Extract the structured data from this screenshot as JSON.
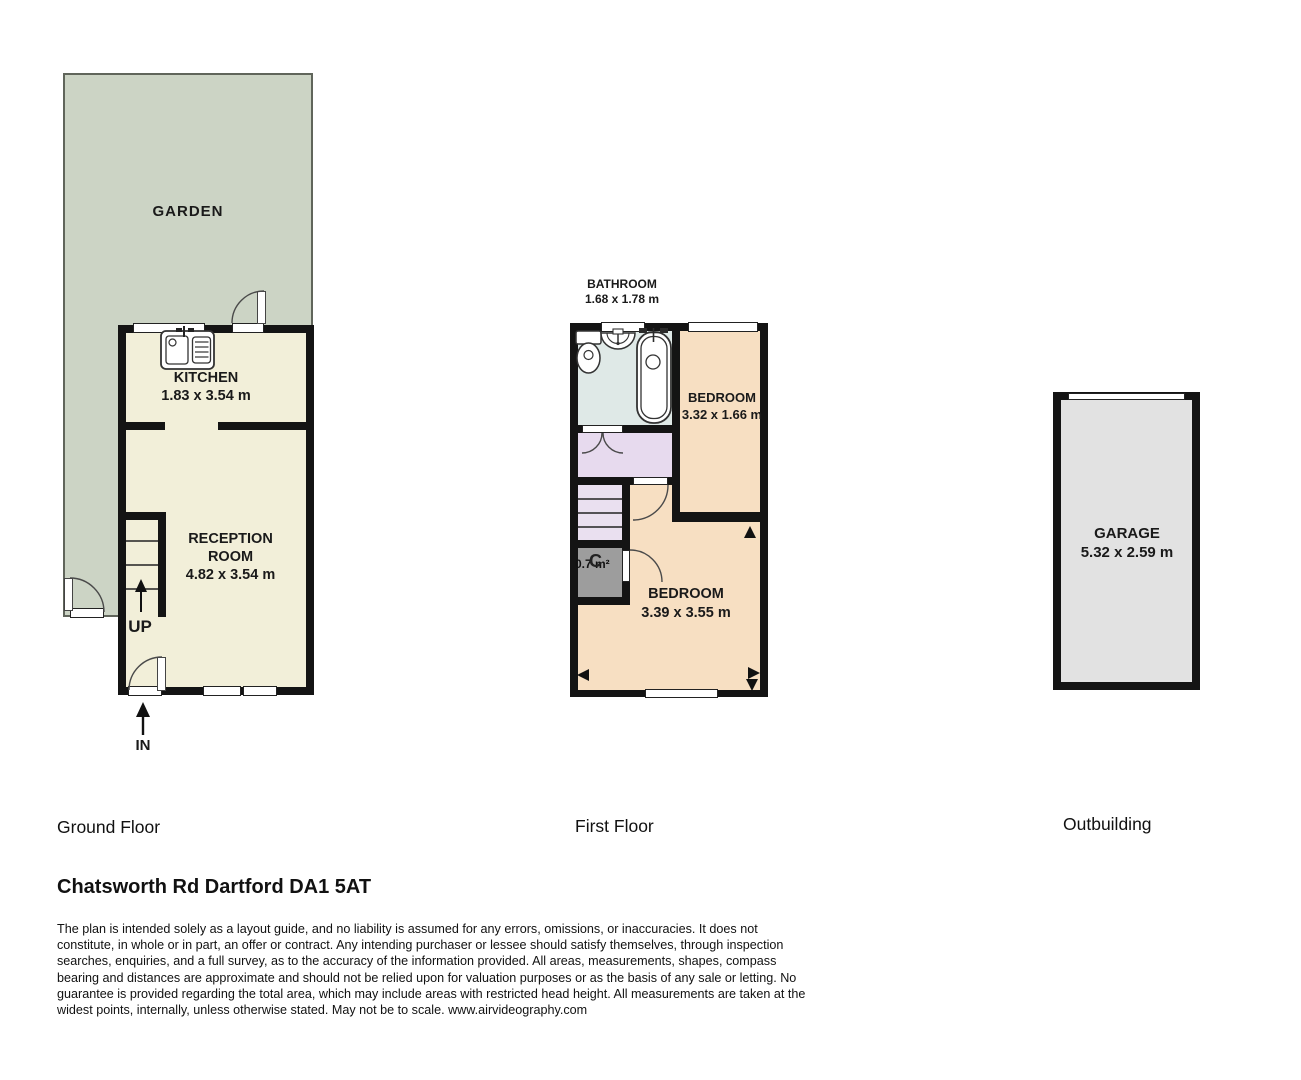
{
  "title": "Chatsworth Rd Dartford DA1 5AT floor plan",
  "colors": {
    "garden": "#ccd4c5",
    "room_cream": "#f2efd9",
    "bathroom_blue": "#dfe9e7",
    "landing_lavender": "#e7daee",
    "stairs_lavender": "#eae0f0",
    "bedroom_peach": "#f7dfc2",
    "cupboard_grey": "#9d9d9d",
    "garage_grey": "#e2e2e2",
    "wall_black": "#141414"
  },
  "ground_floor": {
    "floor_label": "Ground Floor",
    "garden_label": "GARDEN",
    "kitchen_label": "KITCHEN",
    "kitchen_dims": "1.83 x 3.54 m",
    "reception_label_1": "RECEPTION",
    "reception_label_2": "ROOM",
    "reception_dims": "4.82 x 3.54 m",
    "up_label": "UP",
    "in_label": "IN"
  },
  "first_floor": {
    "floor_label": "First Floor",
    "bathroom_label": "BATHROOM",
    "bathroom_dims": "1.68 x 1.78 m",
    "bedroom_small_label": "BEDROOM",
    "bedroom_small_dims": "3.32 x 1.66 m",
    "bedroom_large_label": "BEDROOM",
    "bedroom_large_dims": "3.39 x 3.55 m",
    "cupboard_area": "0.7 m²",
    "cupboard_letter": "C"
  },
  "outbuilding": {
    "floor_label": "Outbuilding",
    "garage_label": "GARAGE",
    "garage_dims": "5.32 x 2.59 m"
  },
  "footer": {
    "address": "Chatsworth Rd Dartford DA1 5AT",
    "disclaimer": "The plan is intended solely as a layout guide, and no liability is assumed for any errors, omissions, or inaccuracies. It does not constitute, in whole or in part, an offer or contract. Any intending purchaser or lessee should satisfy themselves, through inspection searches, enquiries, and a full survey, as to the accuracy of the information provided. All areas, measurements, shapes, compass bearing and distances are approximate and should not be relied upon for valuation purposes or as the basis of any sale or letting. No guarantee is provided regarding the total area, which may include areas with restricted head height. All measurements are taken at the widest points, internally, unless otherwise stated. May not be to scale. www.airvideography.com"
  }
}
